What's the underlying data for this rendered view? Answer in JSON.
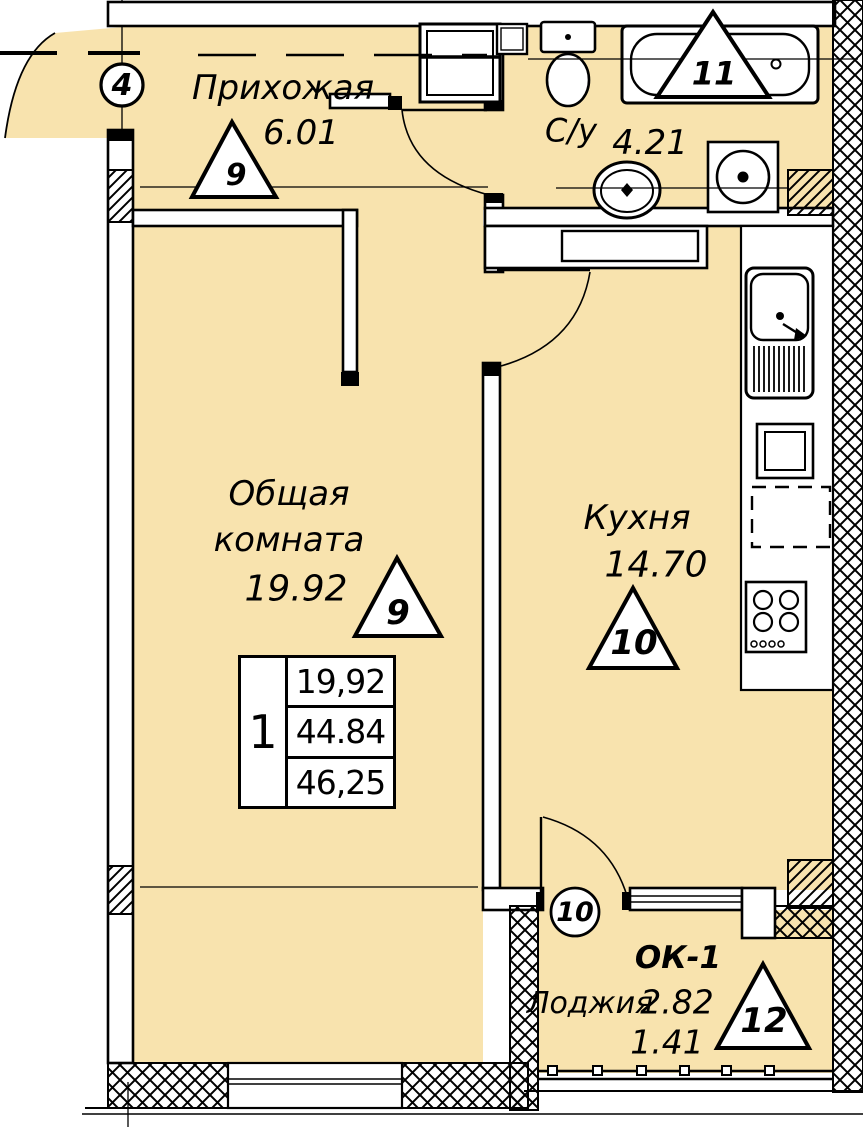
{
  "colors": {
    "room_fill": "#F8E3AE",
    "line": "#000000",
    "wall_fill": "#FFFFFF"
  },
  "rooms": {
    "hallway": {
      "name": "Прихожая",
      "area": "6.01",
      "zone": "9"
    },
    "bathroom": {
      "name": "С/у",
      "area": "4.21",
      "zone": "11"
    },
    "living": {
      "name": "Общая\nкомната",
      "area": "19.92",
      "zone": "9"
    },
    "kitchen": {
      "name": "Кухня",
      "area": "14.70",
      "zone": "10"
    },
    "loggia": {
      "name": "Лоджия",
      "area": "2.82",
      "area_reduced": "1.41",
      "zone": "12",
      "window_mark": "ОК-1"
    }
  },
  "axes": {
    "marker_4": "4",
    "marker_10": "10"
  },
  "summary_table": {
    "rooms_count": "1",
    "living_area": "19,92",
    "apartment_area": "44.84",
    "total_area": "46,25"
  }
}
